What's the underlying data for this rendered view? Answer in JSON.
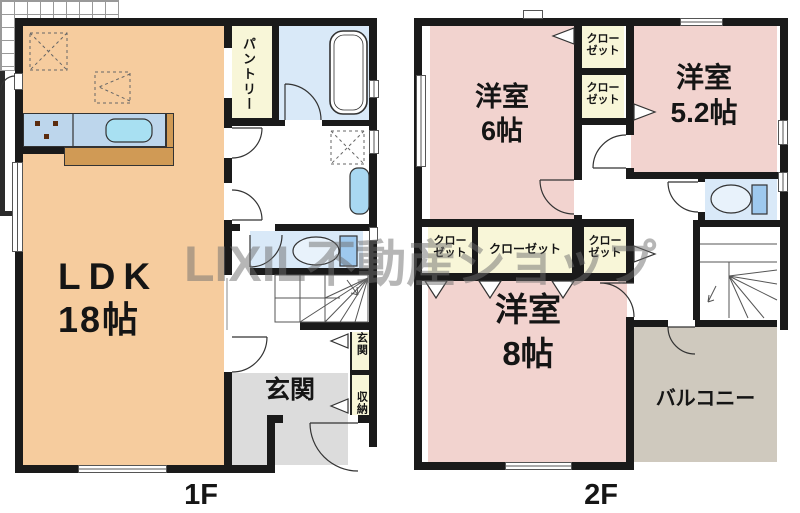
{
  "watermark": "LIXIL不動産ショップ",
  "f1": {
    "label": "1F",
    "ldk_name": "LDK",
    "ldk_size": "18帖",
    "pantry": "パントリー",
    "entrance": "玄関",
    "storage_top": "玄関",
    "storage_bottom": "収納"
  },
  "f2": {
    "label": "2F",
    "room6_name": "洋室",
    "room6_size": "6帖",
    "room52_name": "洋室",
    "room52_size": "5.2帖",
    "room8_name": "洋室",
    "room8_size": "8帖",
    "balcony": "バルコニー",
    "closet_u1_l1": "クロー",
    "closet_u1_l2": "ゼット",
    "closet_u2_l1": "クロー",
    "closet_u2_l2": "ゼット",
    "closet_m1_l1": "クロー",
    "closet_m1_l2": "ゼット",
    "closet_m2": "クローゼット",
    "closet_m3_l1": "クロー",
    "closet_m3_l2": "ゼット"
  },
  "colors": {
    "wall": "#1a1a1a",
    "ldk_floor": "#F6CC9E",
    "bedroom_floor": "#F2D3CF",
    "closet_floor": "#F8F6D8",
    "wet_area_blue": "#D9E9F8",
    "fixture_blue": "#A9D8F2",
    "counter_blue": "#BDD6EC",
    "counter_brown": "#D09A55",
    "entrance_gray": "#DCDCDC",
    "balcony_tan": "#CFC9BE",
    "watermark_gray": "#6e6e6e"
  }
}
